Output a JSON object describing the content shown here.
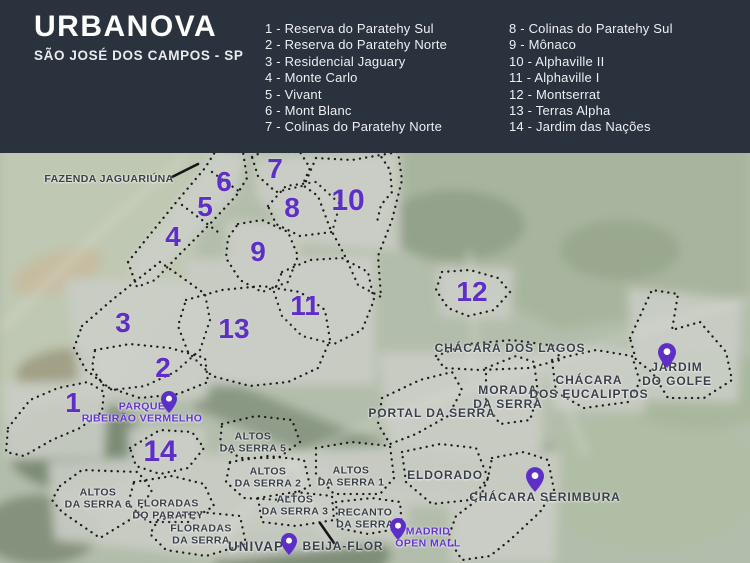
{
  "header": {
    "title": "URBANOVA",
    "subtitle": "SÃO JOSÉ DOS CAMPOS - SP",
    "legend": {
      "column1": [
        "1 - Reserva do Paratehy Sul",
        "2 - Reserva do Paratehy Norte",
        "3 - Residencial Jaguary",
        "4 - Monte Carlo",
        "5 - Vivant",
        "6 - Mont Blanc",
        "7 - Colinas do Paratehy Norte"
      ],
      "column2": [
        "8 - Colinas do Paratehy Sul",
        "9 - Mônaco",
        "10 - Alphaville II",
        "11 - Alphaville I",
        "12 - Montserrat",
        "13 - Terras Alpha",
        "14 - Jardim das Nações"
      ]
    }
  },
  "map": {
    "numbers": [
      "1",
      "2",
      "3",
      "4",
      "5",
      "6",
      "7",
      "8",
      "9",
      "10",
      "11",
      "12",
      "13",
      "14"
    ],
    "labels": {
      "fazenda_jaguariuna": "FAZENDA JAGUARIÚNA",
      "parque_ribeirao_vermelho": "PARQUE\nRIBEIRÃO VERMELHO",
      "chacara_dos_lagos": "CHÁCARA DOS LAGOS",
      "morada_da_serra": "MORADA\nDA SERRA",
      "chacara_dos_eucaliptos": "CHÁCARA\nDOS EUCALIPTOS",
      "jardim_do_golfe": "JARDIM DO GOLFE",
      "portal_da_serra": "PORTAL DA SERRA",
      "eldorado": "ELDORADO",
      "chacara_serimbura": "CHÁCARA SERIMBURA",
      "madrid_open_mall": "MADRID\nOPEN MALL",
      "altos_da_serra_5": "ALTOS\nDA SERRA 5",
      "altos_da_serra_2": "ALTOS\nDA SERRA 2",
      "altos_da_serra_1": "ALTOS\nDA SERRA 1",
      "altos_da_serra_6": "ALTOS\nDA SERRA 6",
      "altos_da_serra_3": "ALTOS\nDA SERRA 3",
      "floradas_do_paratey": "FLORADAS\nDO PARATEY",
      "floradas_da_serra": "FLORADAS\nDA SERRA",
      "recanto_da_serra": "RECANTO\nDA SERRA",
      "univap": "UNIVAP",
      "beija_flor": "BEIJA-FLOR"
    },
    "colors": {
      "accent_purple": "#5e2fc7",
      "header_bg": "#2a323d",
      "label_dark": "#3a404a",
      "boundary_dots": "#1b1b1b"
    }
  }
}
